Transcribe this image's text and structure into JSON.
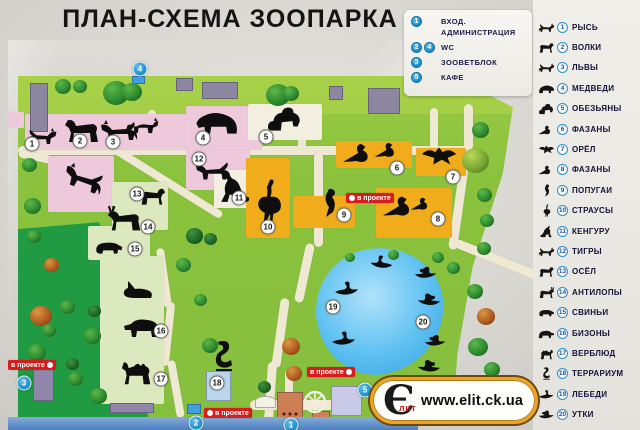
{
  "title": "ПЛАН-СХЕМА ЗООПАРКА",
  "legend": {
    "items": [
      {
        "nums": [
          "1"
        ],
        "lines": [
          "ВХОД.",
          "АДМИНИСТРАЦИЯ"
        ]
      },
      {
        "nums": [
          "2",
          "4"
        ],
        "lines": [
          "WC"
        ]
      },
      {
        "nums": [
          "3"
        ],
        "lines": [
          "ЗООВЕТБЛОК"
        ]
      },
      {
        "nums": [
          "5"
        ],
        "lines": [
          "КАФЕ"
        ]
      }
    ]
  },
  "sidebar": {
    "items": [
      {
        "num": "1",
        "label": "РЫСЬ",
        "icon": "feline"
      },
      {
        "num": "2",
        "label": "ВОЛКИ",
        "icon": "quad"
      },
      {
        "num": "3",
        "label": "ЛЬВЫ",
        "icon": "feline"
      },
      {
        "num": "4",
        "label": "МЕДВЕДИ",
        "icon": "bear"
      },
      {
        "num": "5",
        "label": "ОБЕЗЬЯНЫ",
        "icon": "monkey"
      },
      {
        "num": "6",
        "label": "ФАЗАНЫ",
        "icon": "bird"
      },
      {
        "num": "7",
        "label": "ОРЁЛ",
        "icon": "eagle"
      },
      {
        "num": "8",
        "label": "ФАЗАНЫ",
        "icon": "bird"
      },
      {
        "num": "9",
        "label": "ПОПУГАИ",
        "icon": "parrot"
      },
      {
        "num": "10",
        "label": "СТРАУСЫ",
        "icon": "ostrich"
      },
      {
        "num": "11",
        "label": "КЕНГУРУ",
        "icon": "kangaroo"
      },
      {
        "num": "12",
        "label": "ТИГРЫ",
        "icon": "feline"
      },
      {
        "num": "13",
        "label": "ОСЁЛ",
        "icon": "quad"
      },
      {
        "num": "14",
        "label": "АНТИЛОПЫ",
        "icon": "antelope"
      },
      {
        "num": "15",
        "label": "СВИНЬИ",
        "icon": "pig"
      },
      {
        "num": "16",
        "label": "БИЗОНЫ",
        "icon": "bison"
      },
      {
        "num": "17",
        "label": "ВЕРБЛЮД",
        "icon": "camel"
      },
      {
        "num": "18",
        "label": "ТЕРРАРИУМ",
        "icon": "snake"
      },
      {
        "num": "19",
        "label": "ЛЕБЕДИ",
        "icon": "swan"
      },
      {
        "num": "20",
        "label": "УТКИ",
        "icon": "duck"
      }
    ]
  },
  "map": {
    "project_label": "в проекте",
    "project_labels": [
      {
        "x": 346,
        "y": 193,
        "dot": "left"
      },
      {
        "x": 307,
        "y": 367,
        "dot": "right"
      },
      {
        "x": 8,
        "y": 360,
        "dot": "right"
      },
      {
        "x": 204,
        "y": 408,
        "dot": "left"
      }
    ],
    "markers": [
      {
        "num": "1",
        "x": 32,
        "y": 144
      },
      {
        "num": "2",
        "x": 80,
        "y": 141
      },
      {
        "num": "3",
        "x": 113,
        "y": 142
      },
      {
        "num": "4",
        "x": 203,
        "y": 138
      },
      {
        "num": "5",
        "x": 266,
        "y": 137
      },
      {
        "num": "6",
        "x": 397,
        "y": 168
      },
      {
        "num": "7",
        "x": 453,
        "y": 177
      },
      {
        "num": "8",
        "x": 438,
        "y": 219
      },
      {
        "num": "9",
        "x": 344,
        "y": 215
      },
      {
        "num": "10",
        "x": 268,
        "y": 227
      },
      {
        "num": "11",
        "x": 239,
        "y": 198
      },
      {
        "num": "12",
        "x": 199,
        "y": 159
      },
      {
        "num": "13",
        "x": 137,
        "y": 194
      },
      {
        "num": "14",
        "x": 148,
        "y": 227
      },
      {
        "num": "15",
        "x": 135,
        "y": 249
      },
      {
        "num": "16",
        "x": 161,
        "y": 331
      },
      {
        "num": "17",
        "x": 161,
        "y": 379
      },
      {
        "num": "18",
        "x": 217,
        "y": 383
      },
      {
        "num": "19",
        "x": 333,
        "y": 307
      },
      {
        "num": "20",
        "x": 423,
        "y": 322
      }
    ],
    "facility_markers": [
      {
        "num": "1",
        "x": 291,
        "y": 425
      },
      {
        "num": "2",
        "x": 196,
        "y": 423
      },
      {
        "num": "3",
        "x": 24,
        "y": 383
      },
      {
        "num": "4",
        "x": 140,
        "y": 69
      },
      {
        "num": "5",
        "x": 365,
        "y": 390
      }
    ],
    "enclosures": [
      {
        "x": 6,
        "y": 112,
        "w": 18,
        "h": 16,
        "color": "pink"
      },
      {
        "x": 25,
        "y": 114,
        "w": 172,
        "h": 36,
        "color": "pink"
      },
      {
        "x": 186,
        "y": 106,
        "w": 76,
        "h": 44,
        "color": "pink"
      },
      {
        "x": 248,
        "y": 104,
        "w": 74,
        "h": 36,
        "color": "white"
      },
      {
        "x": 186,
        "y": 150,
        "w": 64,
        "h": 40,
        "color": "pink"
      },
      {
        "x": 48,
        "y": 156,
        "w": 66,
        "h": 56,
        "color": "pink"
      },
      {
        "x": 214,
        "y": 170,
        "w": 38,
        "h": 38,
        "color": "white"
      },
      {
        "x": 246,
        "y": 158,
        "w": 44,
        "h": 80,
        "color": "yellow"
      },
      {
        "x": 336,
        "y": 141,
        "w": 76,
        "h": 27,
        "color": "yellow"
      },
      {
        "x": 416,
        "y": 148,
        "w": 50,
        "h": 28,
        "color": "yellow"
      },
      {
        "x": 376,
        "y": 188,
        "w": 76,
        "h": 50,
        "color": "yellow"
      },
      {
        "x": 293,
        "y": 196,
        "w": 62,
        "h": 32,
        "color": "yellow"
      },
      {
        "x": 112,
        "y": 182,
        "w": 56,
        "h": 48,
        "color": "pale"
      },
      {
        "x": 88,
        "y": 226,
        "w": 62,
        "h": 34,
        "color": "pale"
      },
      {
        "x": 100,
        "y": 256,
        "w": 64,
        "h": 148,
        "color": "pale"
      }
    ],
    "buildings": [
      {
        "x": 30,
        "y": 83,
        "w": 18,
        "h": 49,
        "kind": "gray"
      },
      {
        "x": 176,
        "y": 78,
        "w": 17,
        "h": 13,
        "kind": "gray"
      },
      {
        "x": 202,
        "y": 82,
        "w": 36,
        "h": 17,
        "kind": "gray"
      },
      {
        "x": 329,
        "y": 86,
        "w": 14,
        "h": 14,
        "kind": "gray"
      },
      {
        "x": 368,
        "y": 88,
        "w": 32,
        "h": 26,
        "kind": "gray"
      },
      {
        "x": 33,
        "y": 363,
        "w": 21,
        "h": 38,
        "kind": "purple"
      },
      {
        "x": 110,
        "y": 403,
        "w": 44,
        "h": 10,
        "kind": "purple"
      },
      {
        "x": 206,
        "y": 371,
        "w": 25,
        "h": 30,
        "kind": "ltblue"
      },
      {
        "x": 331,
        "y": 386,
        "w": 31,
        "h": 30,
        "kind": "lavender"
      },
      {
        "x": 277,
        "y": 392,
        "w": 26,
        "h": 29,
        "kind": "orange"
      },
      {
        "x": 312,
        "y": 411,
        "w": 18,
        "h": 14,
        "kind": "orange"
      },
      {
        "x": 255,
        "y": 396,
        "w": 21,
        "h": 12,
        "kind": "white"
      },
      {
        "x": 303,
        "y": 390,
        "w": 24,
        "h": 24,
        "kind": "wheel"
      },
      {
        "x": 132,
        "y": 76,
        "w": 13,
        "h": 8,
        "kind": "blue"
      },
      {
        "x": 187,
        "y": 404,
        "w": 14,
        "h": 10,
        "kind": "blue"
      }
    ],
    "trees": [
      {
        "x": 55,
        "y": 79,
        "s": 16,
        "v": "n"
      },
      {
        "x": 73,
        "y": 80,
        "s": 14,
        "v": "n"
      },
      {
        "x": 103,
        "y": 81,
        "s": 26,
        "v": "n"
      },
      {
        "x": 122,
        "y": 83,
        "s": 20,
        "v": "n"
      },
      {
        "x": 266,
        "y": 84,
        "s": 24,
        "v": "n"
      },
      {
        "x": 283,
        "y": 86,
        "s": 16,
        "v": "n"
      },
      {
        "x": 22,
        "y": 158,
        "s": 15,
        "v": "n"
      },
      {
        "x": 24,
        "y": 198,
        "s": 17,
        "v": "n"
      },
      {
        "x": 27,
        "y": 230,
        "s": 14,
        "v": "n"
      },
      {
        "x": 44,
        "y": 258,
        "s": 15,
        "v": "a"
      },
      {
        "x": 30,
        "y": 306,
        "s": 22,
        "v": "a"
      },
      {
        "x": 42,
        "y": 324,
        "s": 14,
        "v": "n"
      },
      {
        "x": 28,
        "y": 344,
        "s": 18,
        "v": "n"
      },
      {
        "x": 60,
        "y": 300,
        "s": 15,
        "v": "n"
      },
      {
        "x": 84,
        "y": 328,
        "s": 17,
        "v": "n"
      },
      {
        "x": 68,
        "y": 372,
        "s": 15,
        "v": "n"
      },
      {
        "x": 90,
        "y": 388,
        "s": 17,
        "v": "n"
      },
      {
        "x": 66,
        "y": 358,
        "s": 13,
        "v": "d"
      },
      {
        "x": 88,
        "y": 305,
        "s": 13,
        "v": "d"
      },
      {
        "x": 186,
        "y": 228,
        "s": 17,
        "v": "d"
      },
      {
        "x": 204,
        "y": 233,
        "s": 13,
        "v": "d"
      },
      {
        "x": 176,
        "y": 258,
        "s": 15,
        "v": "n"
      },
      {
        "x": 194,
        "y": 294,
        "s": 13,
        "v": "n"
      },
      {
        "x": 202,
        "y": 338,
        "s": 16,
        "v": "n"
      },
      {
        "x": 282,
        "y": 338,
        "s": 18,
        "v": "a"
      },
      {
        "x": 286,
        "y": 366,
        "s": 16,
        "v": "a"
      },
      {
        "x": 258,
        "y": 381,
        "s": 13,
        "v": "d"
      },
      {
        "x": 388,
        "y": 250,
        "s": 11,
        "v": "n"
      },
      {
        "x": 345,
        "y": 253,
        "s": 10,
        "v": "n"
      },
      {
        "x": 472,
        "y": 122,
        "s": 17,
        "v": "n"
      },
      {
        "x": 462,
        "y": 148,
        "s": 27,
        "v": "y"
      },
      {
        "x": 477,
        "y": 188,
        "s": 15,
        "v": "n"
      },
      {
        "x": 480,
        "y": 214,
        "s": 14,
        "v": "n"
      },
      {
        "x": 477,
        "y": 242,
        "s": 14,
        "v": "n"
      },
      {
        "x": 432,
        "y": 252,
        "s": 12,
        "v": "n"
      },
      {
        "x": 447,
        "y": 262,
        "s": 13,
        "v": "n"
      },
      {
        "x": 467,
        "y": 284,
        "s": 16,
        "v": "n"
      },
      {
        "x": 477,
        "y": 308,
        "s": 18,
        "v": "a"
      },
      {
        "x": 468,
        "y": 338,
        "s": 20,
        "v": "n"
      },
      {
        "x": 484,
        "y": 362,
        "s": 16,
        "v": "n"
      },
      {
        "x": 458,
        "y": 388,
        "s": 15,
        "v": "n"
      },
      {
        "x": 497,
        "y": 382,
        "s": 12,
        "v": "n"
      }
    ],
    "animals": [
      {
        "icon": "feline",
        "x": 26,
        "y": 126,
        "w": 32,
        "h": 20
      },
      {
        "icon": "quad",
        "x": 60,
        "y": 116,
        "w": 44,
        "h": 28,
        "flip": true
      },
      {
        "icon": "feline",
        "x": 98,
        "y": 118,
        "w": 42,
        "h": 24,
        "flip": true
      },
      {
        "icon": "fox",
        "x": 126,
        "y": 114,
        "w": 36,
        "h": 22
      },
      {
        "icon": "bear",
        "x": 194,
        "y": 106,
        "w": 46,
        "h": 30,
        "flip": true
      },
      {
        "icon": "monkey",
        "x": 266,
        "y": 103,
        "w": 38,
        "h": 30
      },
      {
        "icon": "feline",
        "x": 194,
        "y": 158,
        "w": 38,
        "h": 24,
        "flip": true
      },
      {
        "icon": "feline",
        "x": 62,
        "y": 162,
        "w": 44,
        "h": 32,
        "flip": true,
        "rot": -20
      },
      {
        "icon": "kangaroo",
        "x": 218,
        "y": 172,
        "w": 32,
        "h": 32,
        "flip": true
      },
      {
        "icon": "ostrich",
        "x": 252,
        "y": 178,
        "w": 32,
        "h": 46
      },
      {
        "icon": "bird",
        "x": 342,
        "y": 140,
        "w": 36,
        "h": 24
      },
      {
        "icon": "bird",
        "x": 374,
        "y": 134,
        "w": 28,
        "h": 30
      },
      {
        "icon": "eagle",
        "x": 420,
        "y": 140,
        "w": 38,
        "h": 32
      },
      {
        "icon": "bird",
        "x": 382,
        "y": 192,
        "w": 38,
        "h": 26
      },
      {
        "icon": "bird",
        "x": 410,
        "y": 188,
        "w": 24,
        "h": 30
      },
      {
        "icon": "parrot",
        "x": 316,
        "y": 188,
        "w": 26,
        "h": 30
      },
      {
        "icon": "quad",
        "x": 138,
        "y": 186,
        "w": 30,
        "h": 20
      },
      {
        "icon": "antelope",
        "x": 106,
        "y": 203,
        "w": 38,
        "h": 30,
        "flip": true
      },
      {
        "icon": "pig",
        "x": 94,
        "y": 238,
        "w": 30,
        "h": 18
      },
      {
        "icon": "rabbit",
        "x": 120,
        "y": 280,
        "w": 36,
        "h": 20,
        "flip": true
      },
      {
        "icon": "bison",
        "x": 122,
        "y": 312,
        "w": 40,
        "h": 28,
        "flip": true
      },
      {
        "icon": "camel",
        "x": 120,
        "y": 355,
        "w": 34,
        "h": 32,
        "flip": true
      },
      {
        "icon": "snake",
        "x": 210,
        "y": 340,
        "w": 28,
        "h": 32
      },
      {
        "icon": "swan",
        "x": 366,
        "y": 254,
        "w": 30,
        "h": 16,
        "flip": true
      },
      {
        "icon": "swan",
        "x": 332,
        "y": 280,
        "w": 30,
        "h": 17
      },
      {
        "icon": "swan",
        "x": 328,
        "y": 330,
        "w": 32,
        "h": 17
      },
      {
        "icon": "duck",
        "x": 414,
        "y": 264,
        "w": 24,
        "h": 17
      },
      {
        "icon": "duck",
        "x": 416,
        "y": 291,
        "w": 25,
        "h": 17,
        "flip": true
      },
      {
        "icon": "duck",
        "x": 424,
        "y": 332,
        "w": 23,
        "h": 17
      },
      {
        "icon": "duck",
        "x": 416,
        "y": 357,
        "w": 25,
        "h": 18,
        "flip": true
      }
    ]
  },
  "logo": {
    "mark": "Є",
    "mark_sub": "лит",
    "url": "www.elit.ck.ua"
  },
  "colors": {
    "legend_blue": "#2196d4",
    "marker_red": "#d81c1c",
    "field_green": "#86bf3e",
    "dark_green": "#149240",
    "pond_blue": "#55bdf0",
    "enclosure_pink": "#eec9dc",
    "enclosure_yellow": "#f0ac1a",
    "enclosure_pale": "#dce8bd",
    "enclosure_white": "#f3efe0",
    "logo_orange": "#eda424"
  }
}
